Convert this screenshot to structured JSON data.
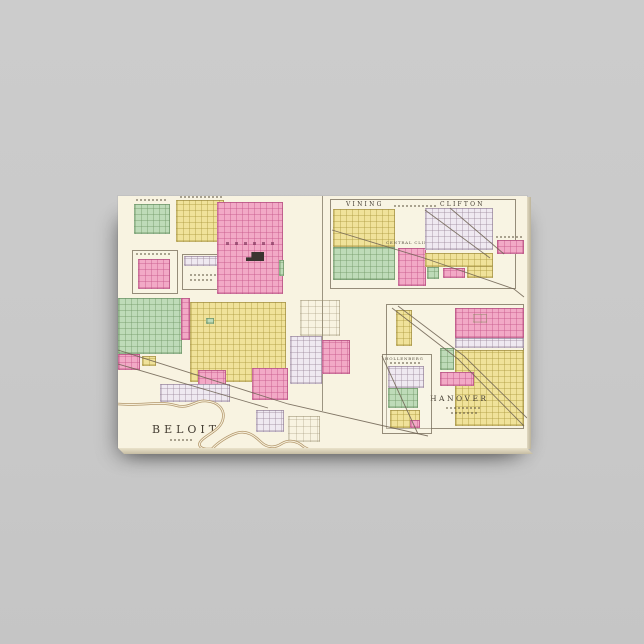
{
  "product": {
    "type": "gallery-wrapped canvas print of a vintage county atlas plate",
    "background_color": "#c9c9c9",
    "canvas_paper_color": "#f8f3e1"
  },
  "map": {
    "labels": {
      "beloit": "BELOIT",
      "vining": "VINING",
      "clifton": "CLIFTON",
      "central_clifton": "CENTRAL CLIFTON",
      "hanover": "HANOVER",
      "hollenberg": "HOLLENBERG"
    },
    "palette": {
      "plat_pink": "#f2a9c6",
      "plat_yellow": "#f0e29a",
      "plat_green": "#bedbb8",
      "plat_lavender": "#efe9f1",
      "paper": "#f8f3e1",
      "ink": "#453e33",
      "river": "#b3976b",
      "railroad": "#6e6252"
    }
  }
}
